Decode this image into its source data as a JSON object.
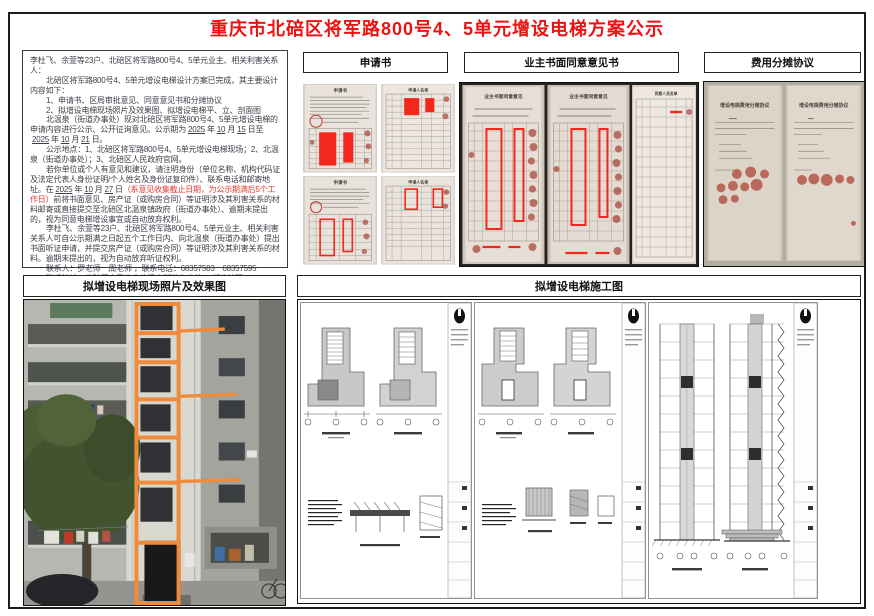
{
  "page": {
    "title": "重庆市北碚区将军路800号4、5单元增设电梯方案公示"
  },
  "colors": {
    "title_red": "#ee1111",
    "notice_red": "#e8382f",
    "elevator_outline_orange": "#ef8b3a"
  },
  "notice": {
    "line1": "李杜飞、余萱等23户、北碚区将军路800号4、5单元业主、相关利害关系人：",
    "line2": "北碚区将军路800号4、5单元增设电梯设计方案已完成，其主要设计内容如下：",
    "line3": "1、申请书、区局审批意见、同意意见书和分摊协议",
    "line4": "2、拟增设电梯现场照片及效果图、拟增设电梯平、立、剖面图",
    "para3": {
      "t1": "北温泉（街道办事处）现对北碚区将军路800号4、5单元增设电梯的申请内容进行公示、公开征询意见。公示期为",
      "y1": "2025",
      "j1": "年",
      "m1": "10",
      "j2": "月",
      "d1": "15",
      "j3": "日至",
      "y2": "2025",
      "j4": "年",
      "m2": "10",
      "j5": "月",
      "d2": "21",
      "j6": "日。"
    },
    "para4": "公示地点：1、北碚区将军路800号4、5单元增设电梯现场；2、北温泉（街道办事处）；3、北碚区人民政府官网。",
    "para5": {
      "t1": "若你单位或个人有意见和建议，请注明身份（单位名称、机构代码证及法定代表人身份证明/个人姓名及身份证复印件）、联系电话和邮寄地址。在",
      "y": "2025",
      "j1": "年",
      "m": "10",
      "j2": "月",
      "d": "27",
      "j3": "日",
      "red": "（系意见收集截止日期，为公示期满后5个工作日）",
      "t2": "前将书面意见、房产证（或购房合同）等证明涉及其利害关系的材料邮寄或直接提交至北碚区北温泉镇政府（街道办事处）、逾期未提出的，视为同意电梯增设事宜或自动放弃权利。"
    },
    "para6": "李杜飞、余萱等23户、北碚区将军路800号4、5单元业主、相关利害关系人可自公示期满之日起五个工作日内、向北温泉（街道办事处）提出书面听证申请，并提交房产证（或购房合同）等证明涉及其利害关系的材料。逾期未提出的，视为自动放弃听证权利。",
    "para7": "联系人：罗老师　周老师 ，联系电话：68357583　68357595",
    "para8": "联系地址：北碚区人民政府北温泉街道办事处 ，邮政编码： 400700"
  },
  "sections": {
    "application": "申请书",
    "consent": "业主书面同意意见书",
    "cost": "费用分摊协议",
    "site_photo": "拟增设电梯现场照片及效果图",
    "drawings": "拟增设电梯施工图"
  },
  "photo_labels": {
    "application": "申请书",
    "applicant_list": "申请人名单",
    "consent": "业主书面同意意见",
    "consent_list": "同意人员名单",
    "cost": "增设电梯费用分摊协议"
  }
}
